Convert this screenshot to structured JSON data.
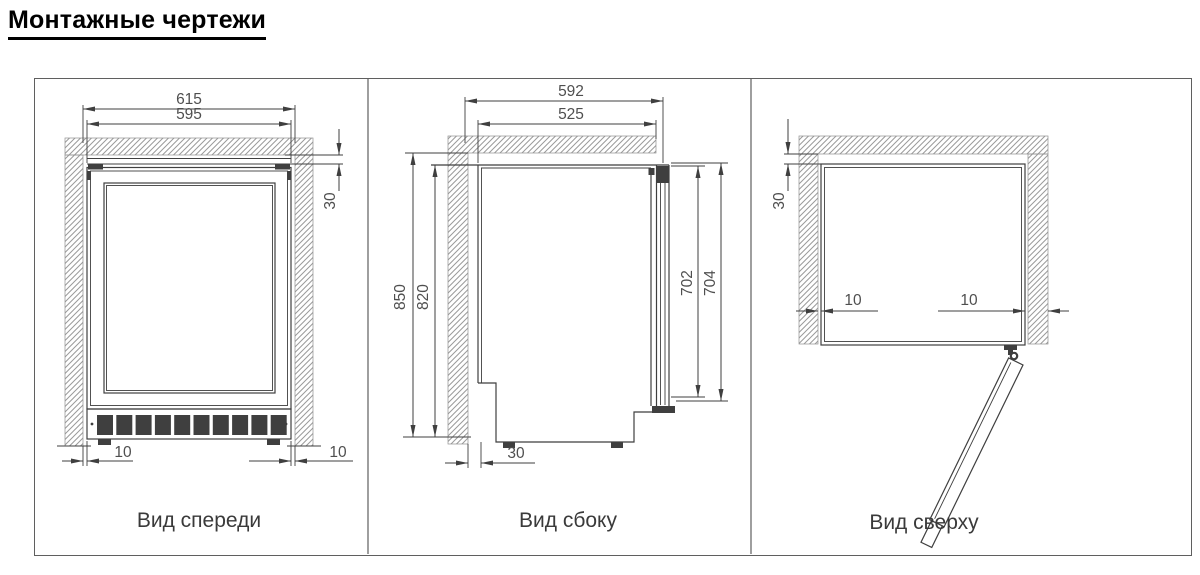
{
  "title": "Монтажные чертежи",
  "colors": {
    "line": "#3f3f3f",
    "hatch": "#9a9a9a",
    "dim_text": "#4f4f4f",
    "border": "#5f5f5f",
    "background": "#ffffff"
  },
  "views": {
    "front": {
      "label": "Вид спереди",
      "dims": {
        "niche_width": "615",
        "body_width": "595",
        "top_clearance": "30",
        "left_clearance": "10",
        "right_clearance": "10"
      }
    },
    "side": {
      "label": "Вид сбоку",
      "dims": {
        "niche_depth": "592",
        "body_depth": "525",
        "niche_height": "850",
        "body_height": "820",
        "door_inner_height": "702",
        "door_height": "704",
        "rear_clearance": "30"
      }
    },
    "top": {
      "label": "Вид сверху",
      "dims": {
        "rear_clearance": "30",
        "left_clearance": "10",
        "right_clearance": "10"
      }
    }
  }
}
